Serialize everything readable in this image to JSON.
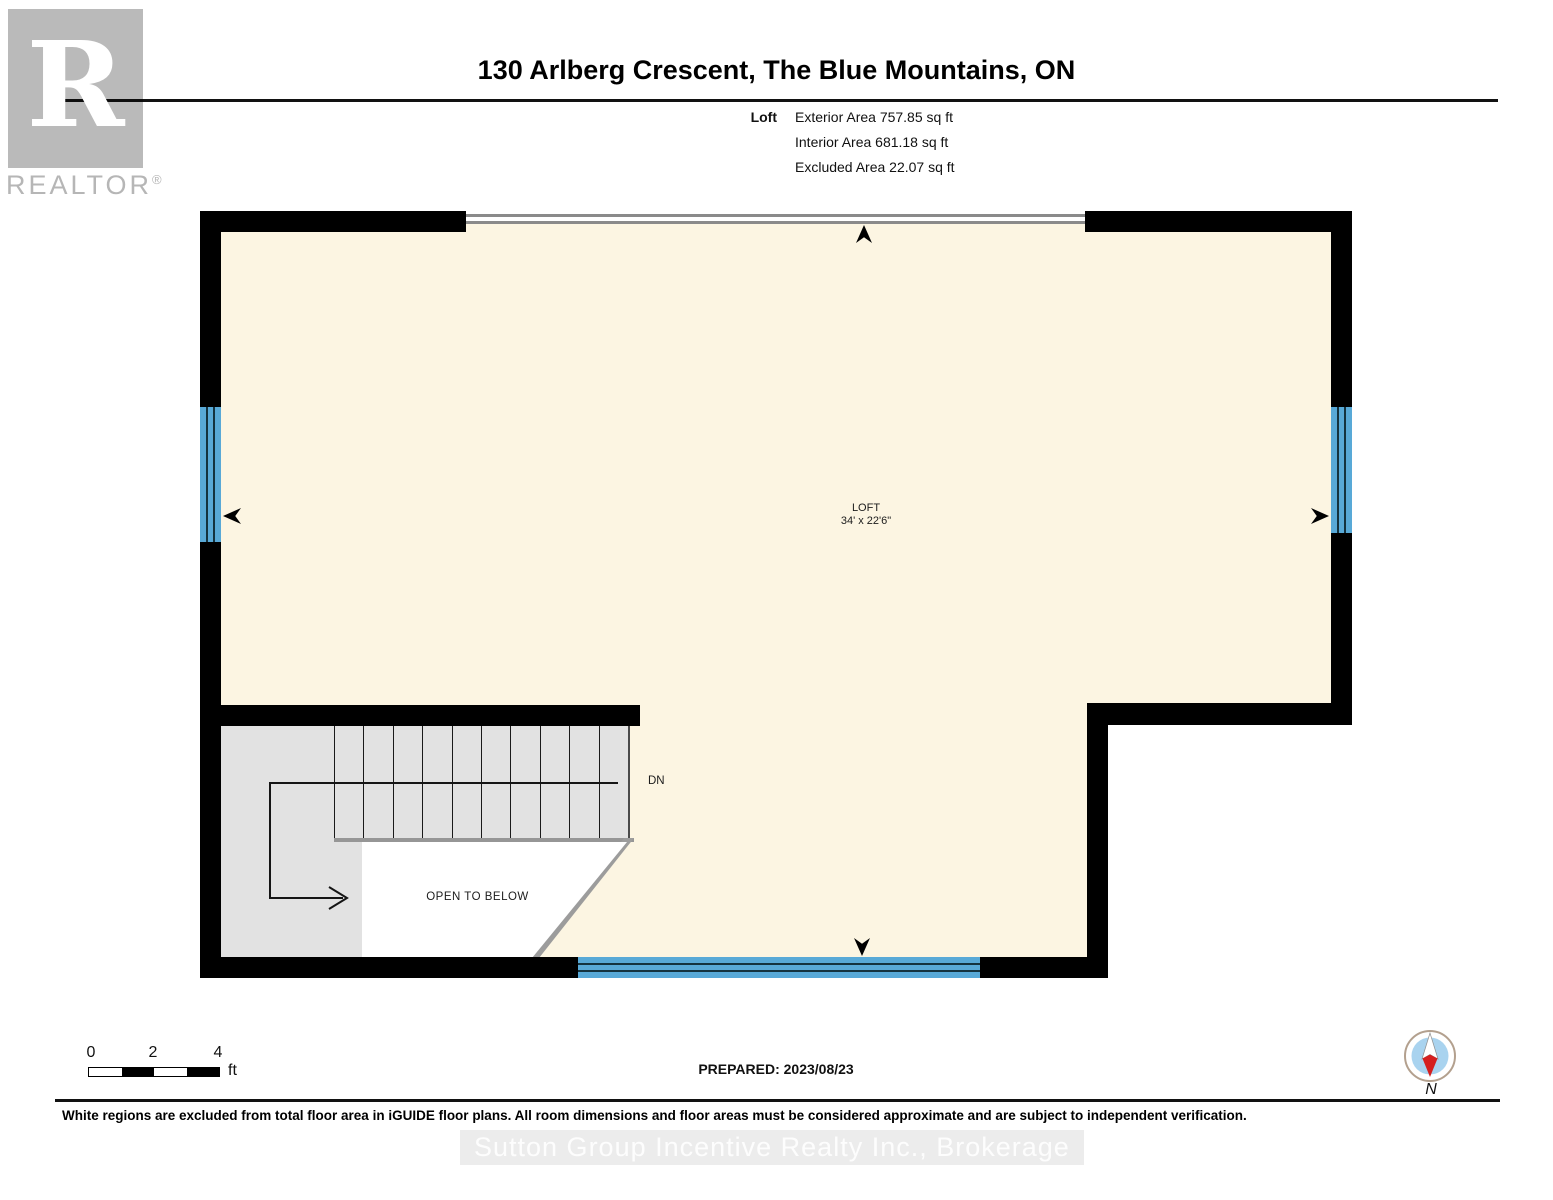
{
  "header": {
    "logo": {
      "letter": "R",
      "brand": "REALTOR",
      "registered": "®"
    },
    "title": "130 Arlberg Crescent, The Blue Mountains, ON",
    "floor_label": "Loft",
    "area_lines": [
      "Exterior Area 757.85 sq ft",
      "Interior Area 681.18 sq ft",
      "Excluded Area 22.07 sq ft"
    ]
  },
  "plan": {
    "room": {
      "name": "LOFT",
      "dims": "34' x 22'6\""
    },
    "stairs": {
      "down_label": "DN",
      "open_label": "OPEN TO BELOW"
    }
  },
  "footer": {
    "scale": {
      "ticks": [
        "0",
        "2",
        "4"
      ],
      "unit": "ft"
    },
    "prepared": "PREPARED: 2023/08/23",
    "compass_label": "N",
    "disclaimer": "White regions are excluded from total floor area in iGUIDE floor plans. All room dimensions and floor areas must be considered approximate and are subject to independent verification.",
    "watermark": "Sutton Group Incentive Realty Inc., Brokerage"
  },
  "colors": {
    "floor": "#fcf5e2",
    "window_blue": "#58a9d7",
    "wall": "#000000",
    "stair_gray": "#e2e2e2",
    "compass_inner": "#a9d3ef",
    "compass_needle_red": "#d51f1f"
  }
}
